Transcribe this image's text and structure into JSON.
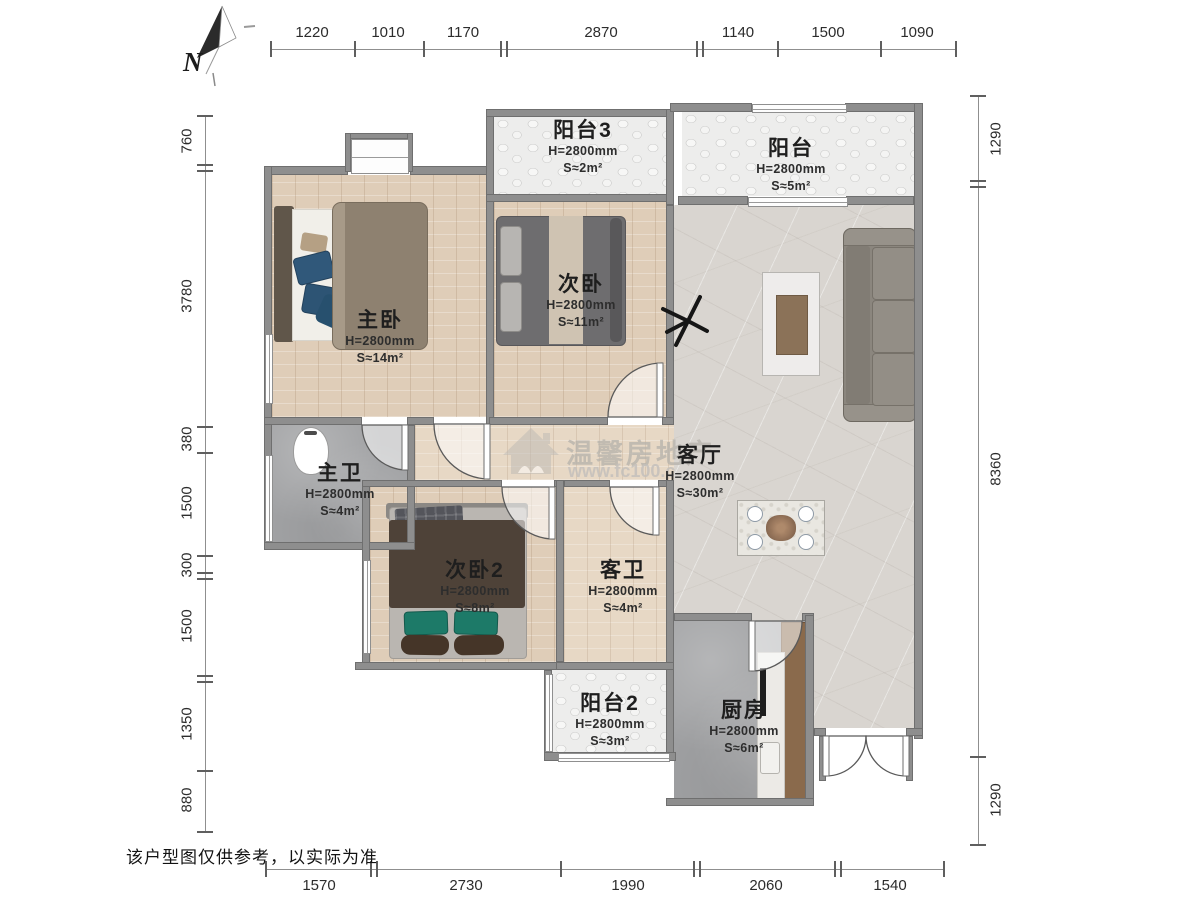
{
  "meta": {
    "north": "N",
    "disclaimer": "该户型图仅供参考，以实际为准"
  },
  "watermark": {
    "brand": "温馨房地产",
    "url": "www.fc100.c",
    "icon": "house-logo-icon"
  },
  "dims": {
    "top": [
      "1220",
      "1010",
      "1170",
      "2870",
      "1140",
      "1500",
      "1090"
    ],
    "left": [
      "760",
      "3780",
      "380",
      "1500",
      "300",
      "1500",
      "1350",
      "880"
    ],
    "right": [
      "1290",
      "8360",
      "1290"
    ],
    "bottom": [
      "1570",
      "2730",
      "1990",
      "2060",
      "1540"
    ]
  },
  "rooms": {
    "balcony3": {
      "name": "阳台3",
      "height": "H=2800mm",
      "area": "S≈2m²"
    },
    "balcony": {
      "name": "阳台",
      "height": "H=2800mm",
      "area": "S≈5m²"
    },
    "master": {
      "name": "主卧",
      "height": "H=2800mm",
      "area": "S≈14m²"
    },
    "bedroom2": {
      "name": "次卧",
      "height": "H=2800mm",
      "area": "S≈11m²"
    },
    "masterbath": {
      "name": "主卫",
      "height": "H=2800mm",
      "area": "S≈4m²"
    },
    "bedroom3": {
      "name": "次卧2",
      "height": "H=2800mm",
      "area": "S≈8m²"
    },
    "guestbath": {
      "name": "客卫",
      "height": "H=2800mm",
      "area": "S≈4m²"
    },
    "living": {
      "name": "客厅",
      "height": "H=2800mm",
      "area": "S≈30m²"
    },
    "balcony2": {
      "name": "阳台2",
      "height": "H=2800mm",
      "area": "S≈3m²"
    },
    "kitchen": {
      "name": "厨房",
      "height": "H=2800mm",
      "area": "S≈6m²"
    }
  },
  "colors": {
    "wall": "#8e8e8e",
    "wood_floor": "#dfcdb8",
    "gray_tile": "#a0a1a3",
    "living_tile": "#d9d5d0",
    "balcony_pebble": "#ededec",
    "teal_pillow": "#1d7a68",
    "blue_pillow": "#2f5878",
    "chair_brown": "#8a5732"
  }
}
